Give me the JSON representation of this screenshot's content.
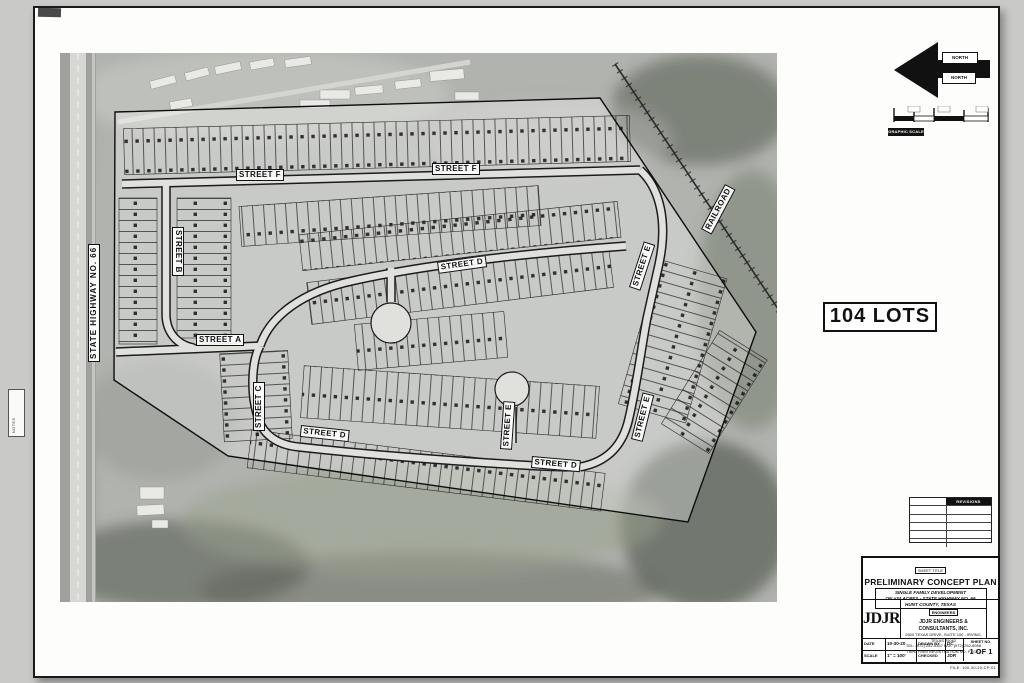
{
  "sheet": {
    "lots_text": "104 LOTS",
    "edge_note": "NOTES",
    "north_labels": [
      "NORTH",
      "NORTH"
    ],
    "scale_label": "GRAPHIC SCALE"
  },
  "map": {
    "street_labels": [
      "STREET F",
      "STREET F",
      "STREET B",
      "STREET D",
      "STREET E",
      "STREET A",
      "STREET C",
      "STREET E",
      "STREET D",
      "STREET D",
      "STREET E"
    ],
    "highway_label": "STATE HIGHWAY NO. 66",
    "railroad_label": "RAILROAD"
  },
  "revisions": {
    "header": "REVISIONS"
  },
  "title_block": {
    "sheet_title_label": "SHEET TITLE",
    "title": "PRELIMINARY CONCEPT PLAN",
    "subtitle_lines": [
      "SINGLE FAMILY DEVELOPMENT",
      "ON ±34 ACRES - STATE HIGHWAY NO. 66",
      "HUNT COUNTY, TEXAS"
    ],
    "logo_text": "JDJR",
    "firm_label": "ENGINEERS",
    "firm_name": "JDJR ENGINEERS & CONSULTANTS, INC.",
    "firm_address": "2500 TEXAS DRIVE, SUITE 100 - IRVING, TEXAS 75062",
    "firm_phone": "TEL: (972) 252-5357  FAX: (972) 252-8958",
    "firm_note": "TBPE FIRM REGISTRATION NO. F-2121",
    "fields": {
      "date_label": "DATE",
      "date_value": "10-30-20",
      "drawn_label": "DRAWN BY",
      "drawn_value": "DC",
      "scale_label": "SCALE",
      "scale_value": "1\" = 100'",
      "checked_label": "CHECKED BY",
      "checked_value": "JDR",
      "sheet_no_label": "SHEET NO.",
      "sheet_no_value": "1 OF 1"
    },
    "footer_note": "FILE: 100-30-20-CP-01"
  }
}
